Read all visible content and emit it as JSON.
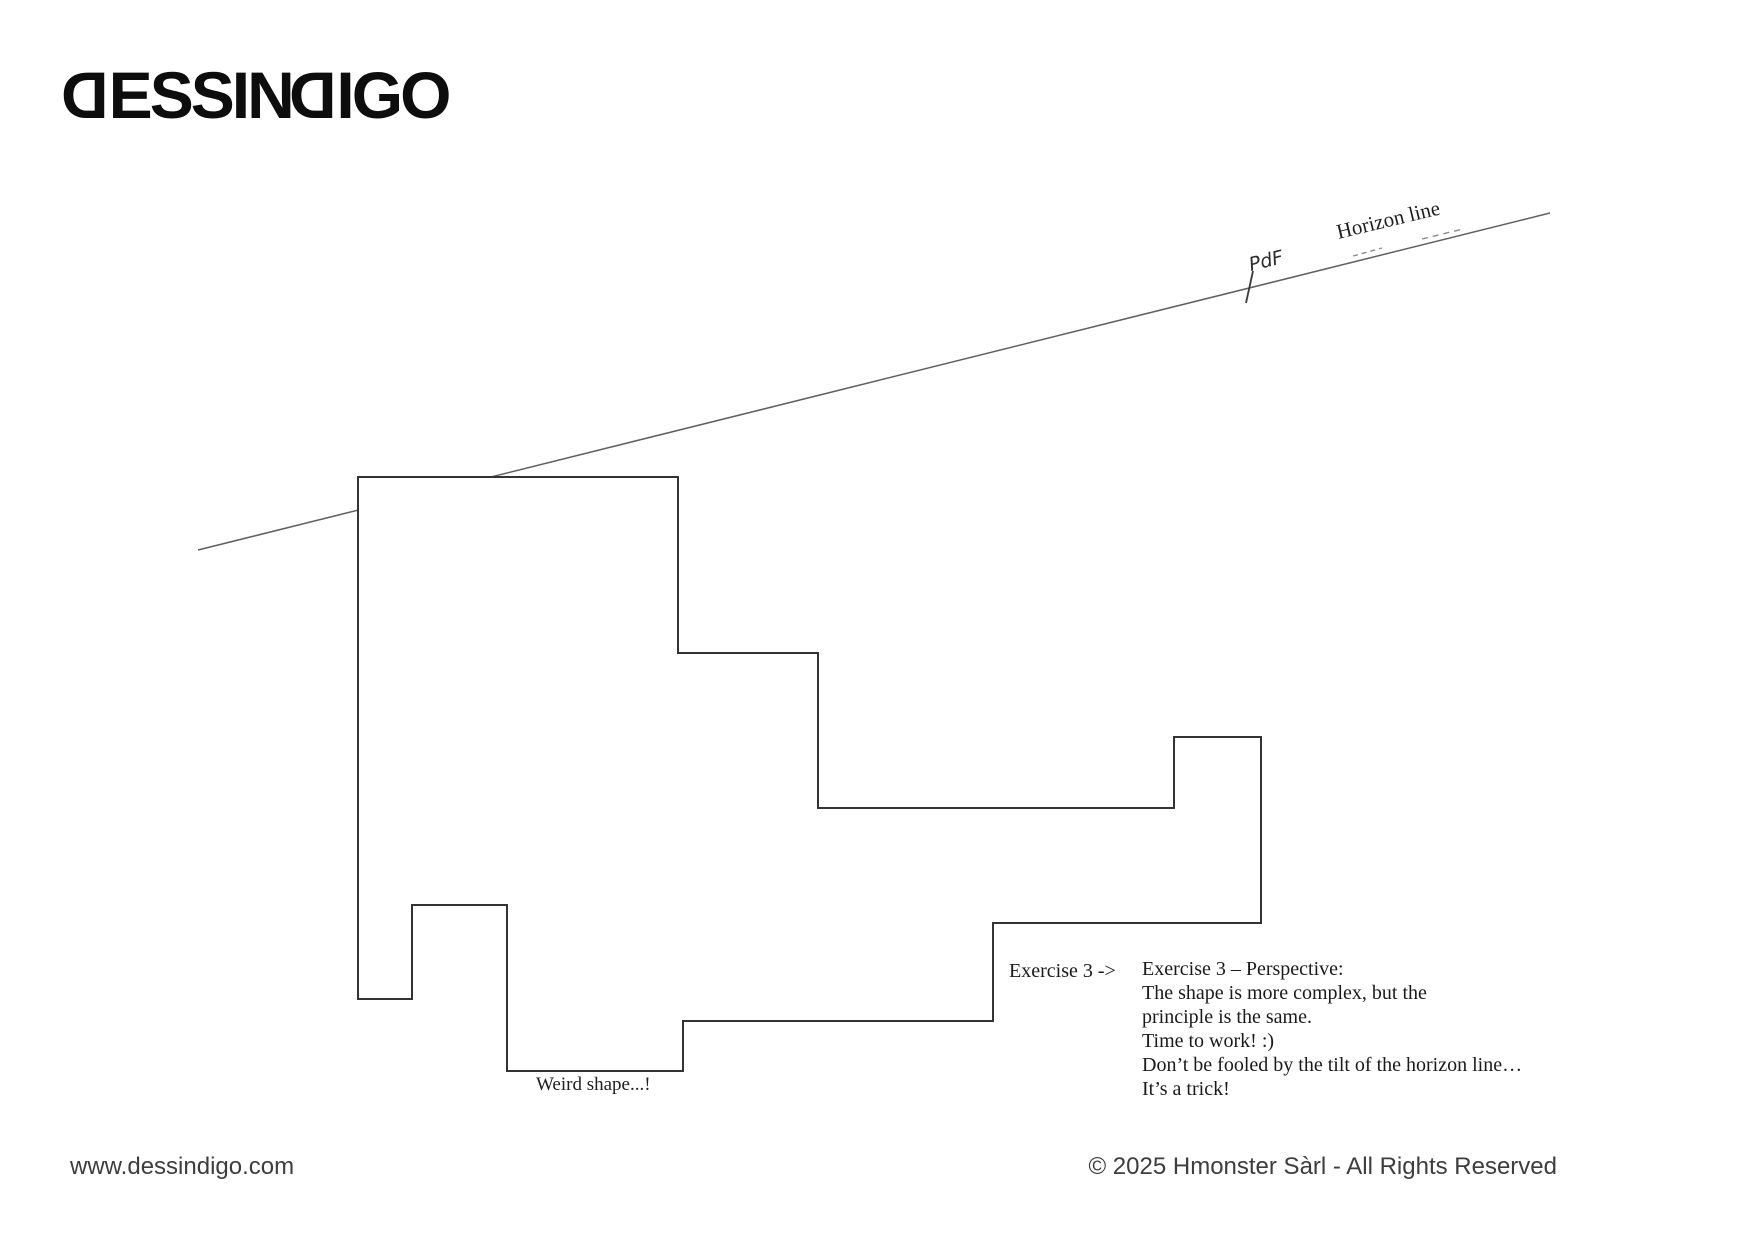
{
  "page": {
    "background": "#ffffff"
  },
  "logo": {
    "text": "DESSINDIGO",
    "color": "#0d0d0d",
    "parts": [
      {
        "text": "D",
        "mirrored": true
      },
      {
        "text": "ESSIN",
        "mirrored": false
      },
      {
        "text": "D",
        "mirrored": true
      },
      {
        "text": "IGO",
        "mirrored": false
      }
    ]
  },
  "figure": {
    "horizon_line": {
      "label": "Horizon line",
      "points": "198,550 1550,213",
      "color": "#5f5f5f"
    },
    "vanishing_point": {
      "label": "PdF",
      "tick_points": "1246,303 1253,271",
      "color": "#3a3a3a"
    },
    "sketch_dashes": {
      "dash1": "1353,256 1382,248",
      "dash2": "1422,239 1463,229",
      "color": "#8a8a8a"
    },
    "weird_shape": {
      "caption": "Weird shape...!",
      "points": "358,477 678,477 678,653 818,653 818,808 1174,808 1174,737 1261,737 1261,923 993,923 993,1021 683,1021 683,1071 507,1071 507,905 412,905 412,999 358,999",
      "stroke": "#343434",
      "fill": "#ffffff"
    }
  },
  "exercise": {
    "pointer_label": "Exercise 3 ->",
    "text": "Exercise 3 – Perspective:\nThe shape is more complex, but the\nprinciple is the same.\nTime to work! :)\nDon’t be fooled by the tilt of the horizon line…\nIt’s a trick!"
  },
  "footer": {
    "website": "www.dessindigo.com",
    "copyright": "© 2025 Hmonster Sàrl - All Rights Reserved"
  }
}
